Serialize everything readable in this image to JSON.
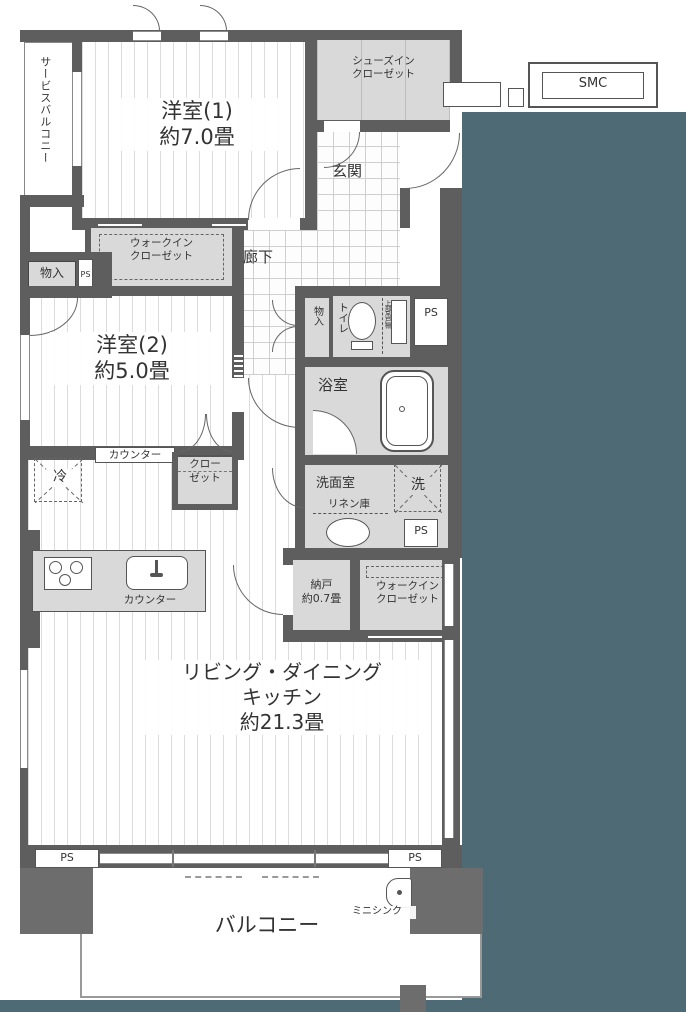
{
  "colors": {
    "outside": "#4e6a74",
    "wall": "#5e5e5e",
    "wall_block": "#6d6d6d",
    "room_gray": "#d9d9d9",
    "floor_line": "#dcdcdc",
    "tile_line": "#cfcfcf"
  },
  "labels": {
    "service_balcony": "サービスバルコニー",
    "room1_name": "洋室(1)",
    "room1_size": "約7.0畳",
    "sic_line1": "シューズイン",
    "sic_line2": "クローゼット",
    "smc": "SMC",
    "genkan": "玄関",
    "wic_line1": "ウォークイン",
    "wic_line2": "クローゼット",
    "hallway": "廊下",
    "storage_left": "物入",
    "ps": "PS",
    "room2_name": "洋室(2)",
    "room2_size": "約5.0畳",
    "hall_storage": "物入",
    "toilet": "トイレ",
    "upper_cabinet": "上部吊戸棚",
    "bathroom": "浴室",
    "washroom": "洗面室",
    "linen": "リネン庫",
    "washer": "洗",
    "fridge": "冷",
    "counter": "カウンター",
    "closet_line1": "クロー",
    "closet_line2": "ゼット",
    "nando_name": "納戸",
    "nando_size": "約0.7畳",
    "ldk_line1": "リビング・ダイニング",
    "ldk_line2": "キッチン",
    "ldk_size": "約21.3畳",
    "balcony": "バルコニー",
    "mini_sink": "ミニシンク"
  }
}
